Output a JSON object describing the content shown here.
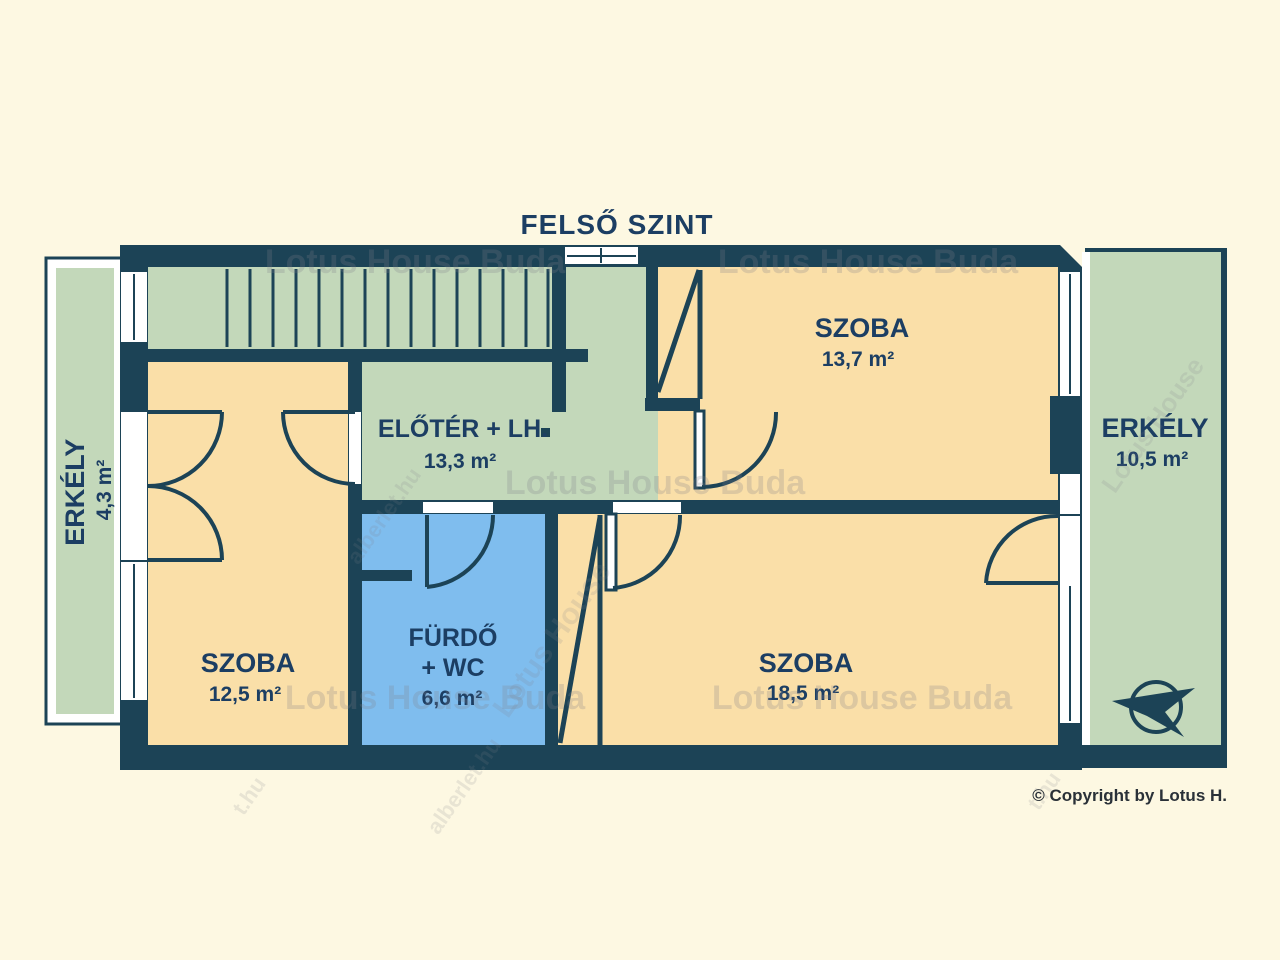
{
  "title": "FELSŐ SZINT",
  "copyright": "© Copyright by Lotus H.",
  "watermarks": {
    "brand": "Lotus House Buda",
    "brand_short": "Lotus House",
    "site": "alberlet.hu",
    "site_short": "t.hu"
  },
  "rooms": {
    "balcony_left": {
      "name": "ERKÉLY",
      "area": "4,3 m²"
    },
    "bedroom_left": {
      "name": "SZOBA",
      "area": "12,5 m²"
    },
    "hall": {
      "name": "ELŐTÉR + LH.",
      "area": "13,3 m²"
    },
    "bathroom": {
      "name_line1": "FÜRDŐ",
      "name_line2": "+ WC",
      "area": "6,6 m²"
    },
    "bedroom_top": {
      "name": "SZOBA",
      "area": "13,7 m²"
    },
    "bedroom_bottom": {
      "name": "SZOBA",
      "area": "18,5 m²"
    },
    "balcony_right": {
      "name": "ERKÉLY",
      "area": "10,5 m²"
    }
  },
  "colors": {
    "wall": "#1c4356",
    "room": "#fadfa8",
    "hall": "#c3d8ba",
    "bath": "#7fbdee",
    "background": "#fdf8e2",
    "label": "#1c3e63",
    "watermark": "#80808a"
  }
}
